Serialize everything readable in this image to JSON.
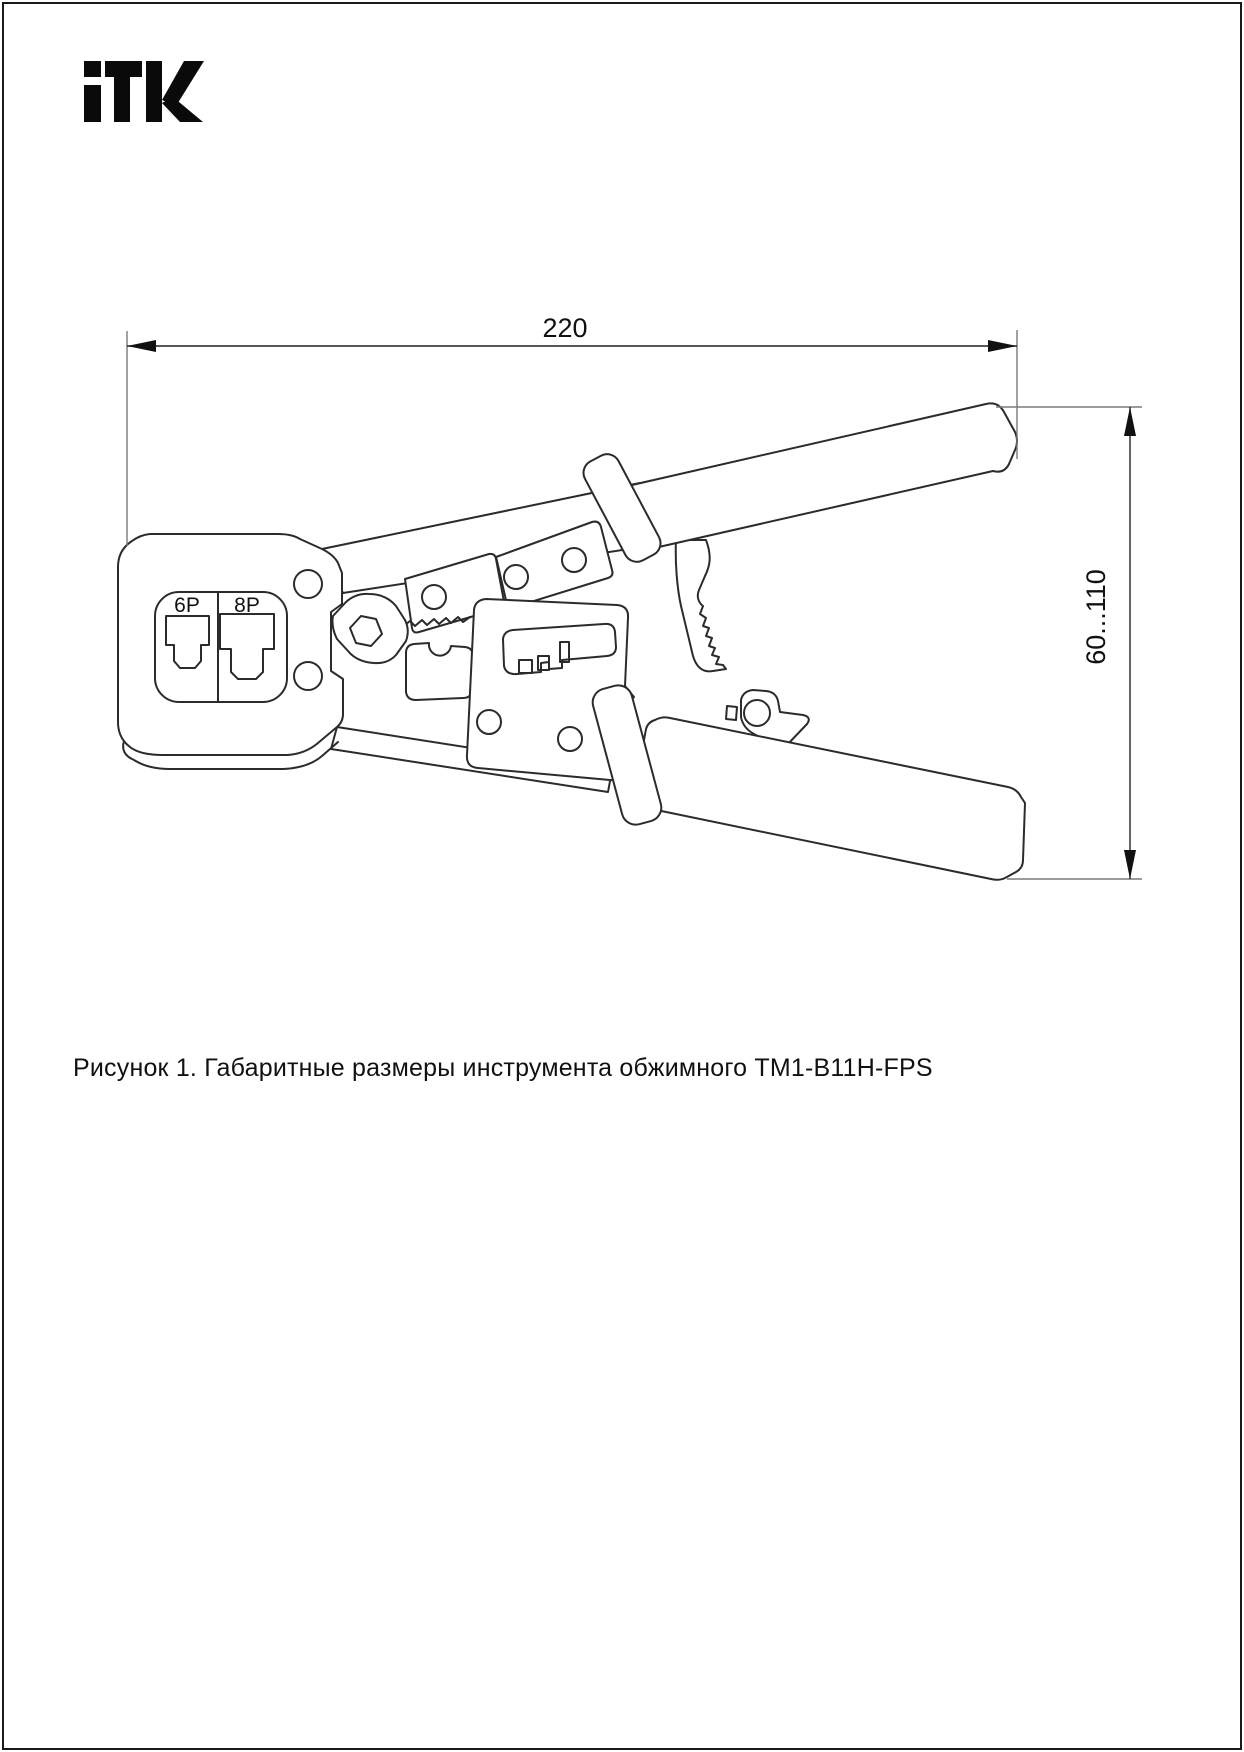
{
  "page": {
    "background": "#ffffff",
    "border_color": "#1a1a1a"
  },
  "logo": {
    "text": "ITK",
    "color": "#0a0a0a"
  },
  "drawing": {
    "subject": "crimping tool side view",
    "line_color": "#2b2b2b",
    "port_labels": {
      "left": "6P",
      "right": "8P"
    },
    "dimensions": {
      "width": "220",
      "height_range": "60...110"
    }
  },
  "caption": {
    "text": "Рисунок 1. Габаритные размеры инструмента обжимного TM1-B11H-FPS"
  }
}
